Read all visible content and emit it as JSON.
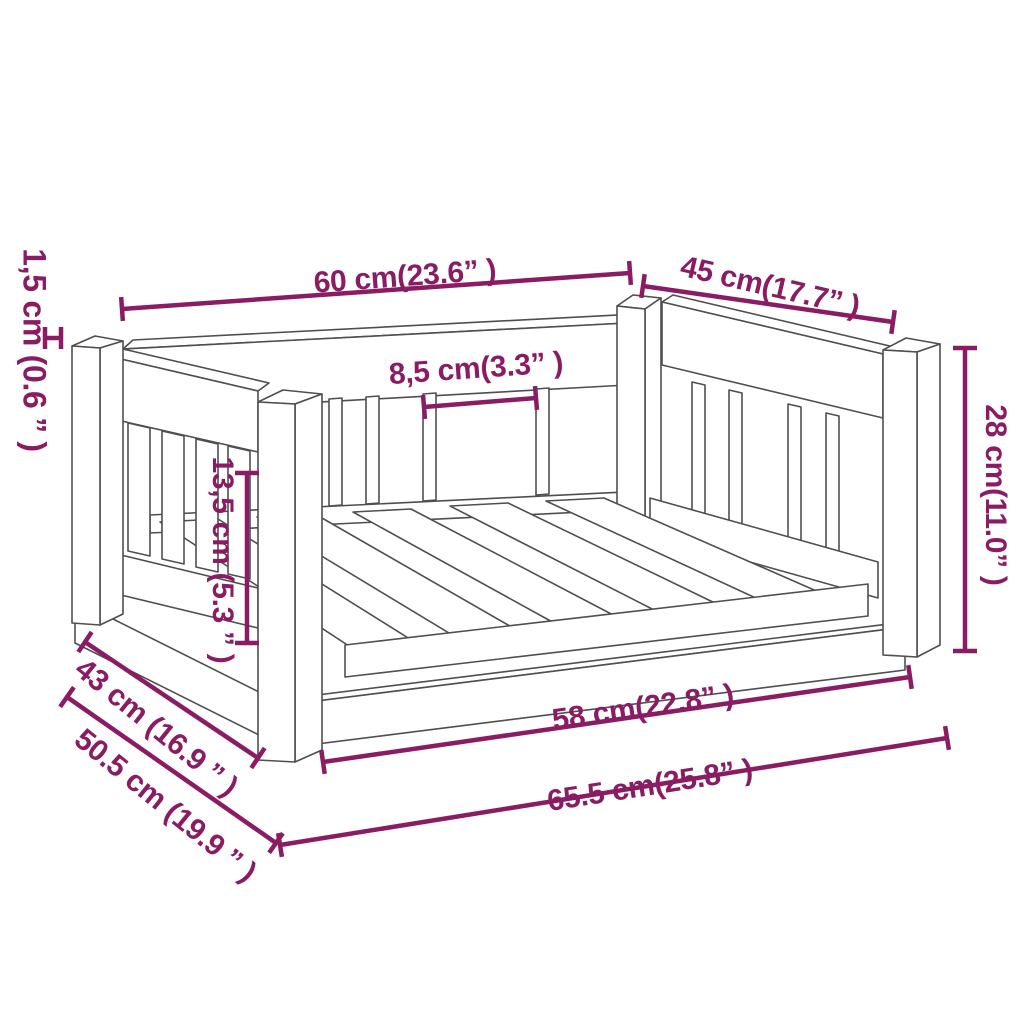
{
  "diagram": {
    "type": "product-dimension-diagram",
    "product": "wooden slatted dog bed",
    "view": "perspective wireframe line drawing",
    "colors": {
      "dimension": "#8a1c64",
      "outline": "#4f4f4f",
      "background": "#ffffff"
    },
    "units": {
      "primary": "cm",
      "secondary": "inch"
    },
    "dims": [
      {
        "name": "board-thickness",
        "label": "1,5 cm (0.6 ” )",
        "cm": "1,5",
        "inch": "0.6",
        "line": [
          45,
          338,
          61,
          338
        ],
        "tick": 11
      },
      {
        "name": "top-back-rail-length",
        "label": "60 cm(23.6” )",
        "cm": "60",
        "inch": "23.6",
        "line": [
          122,
          309,
          630,
          273
        ],
        "tick": 12
      },
      {
        "name": "top-side-rail-length",
        "label": "45 cm(17.7” )",
        "cm": "45",
        "inch": "17.7",
        "line": [
          643,
          286,
          893,
          322
        ],
        "tick": 12
      },
      {
        "name": "slat-gap",
        "label": "8,5 cm(3.3” )",
        "cm": "8,5",
        "inch": "3.3",
        "line": [
          424,
          407,
          536,
          398
        ],
        "tick": 12
      },
      {
        "name": "inner-side-height",
        "label": "13,5 cm (5.3 ” )",
        "cm": "13,5",
        "inch": "5.3",
        "line": [
          247,
          473,
          247,
          643
        ],
        "tick": 12
      },
      {
        "name": "overall-height",
        "label": "28 cm(11.0” )",
        "cm": "28",
        "inch": "11.0",
        "line": [
          965,
          348,
          965,
          651
        ],
        "tick": 12
      },
      {
        "name": "inner-front-length",
        "label": "58 cm(22.8” )",
        "cm": "58",
        "inch": "22.8",
        "line": [
          323,
          762,
          910,
          677
        ],
        "tick": 12
      },
      {
        "name": "overall-length",
        "label": "65.5 cm(25.8” )",
        "cm": "65.5",
        "inch": "25.8",
        "line": [
          280,
          845,
          947,
          738
        ],
        "tick": 12
      },
      {
        "name": "inner-side-depth",
        "label": "43 cm (16.9 ” )",
        "cm": "43",
        "inch": "16.9",
        "line": [
          85,
          642,
          258,
          758
        ],
        "tick": 12
      },
      {
        "name": "overall-depth",
        "label": "50.5 cm (19.9 ” )",
        "cm": "50.5",
        "inch": "19.9",
        "line": [
          67,
          697,
          276,
          843
        ],
        "tick": 12
      }
    ]
  }
}
